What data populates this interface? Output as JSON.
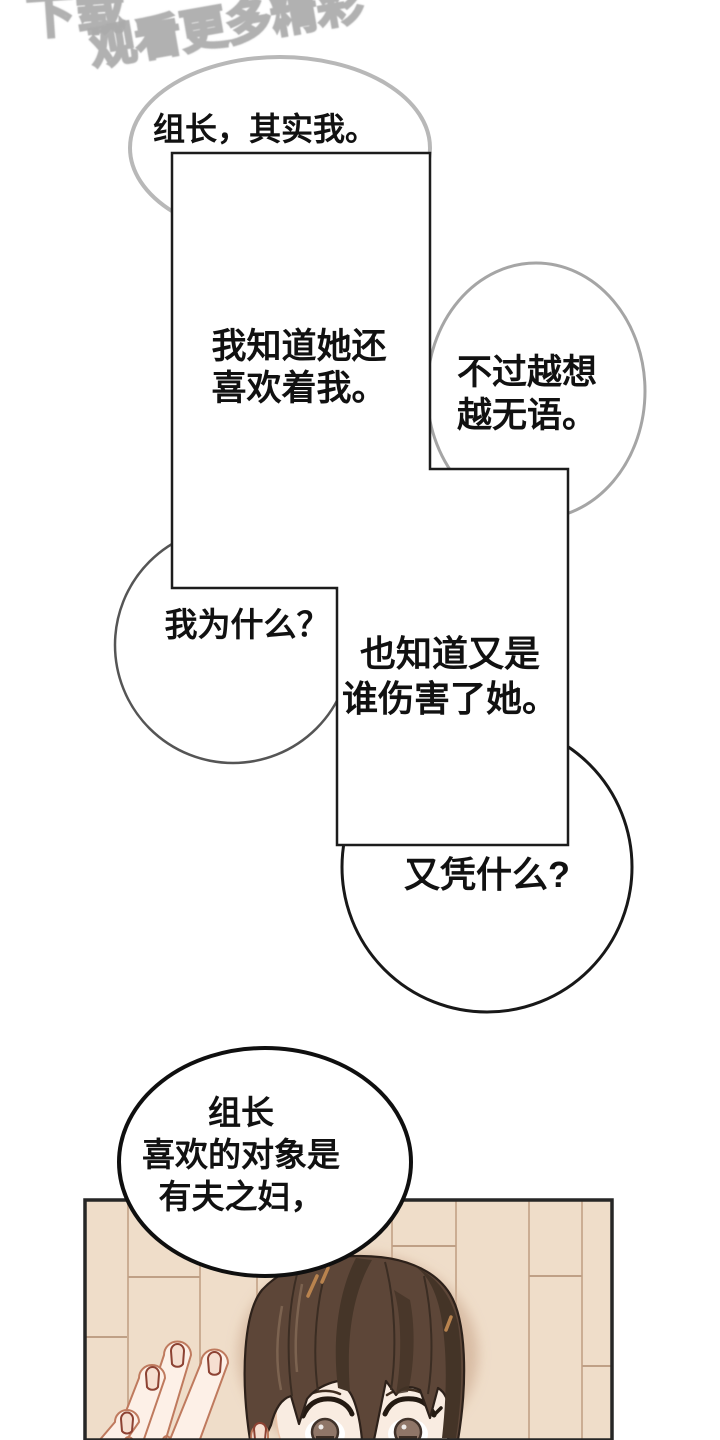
{
  "watermark": {
    "line1": "下载",
    "line2": "观看更多精彩"
  },
  "speech": {
    "top_circle": "组长，其实我。",
    "panel_a": {
      "line1": "我知道她还",
      "line2": "喜欢着我。"
    },
    "right_circle": {
      "line1": "不过越想",
      "line2": "越无语。"
    },
    "left_circle": "我为什么？",
    "panel_b": {
      "line1": "也知道又是",
      "line2": "谁伤害了她。"
    },
    "question_circle": "又凭什么?",
    "bottom_circle": {
      "line1": "组长",
      "line2": "喜欢的对象是",
      "line3": "有夫之妇，"
    }
  },
  "colors": {
    "background": "#ffffff",
    "text": "#111111",
    "watermark_stroke": "#ababab",
    "bubble_border_light": "#b8b8b8",
    "bubble_border_mid": "#a5a5a5",
    "bubble_border_dark": "#555555",
    "bubble_border_black": "#181818",
    "panel_border": "#1c1c1c",
    "photo_panel_border": "#262626",
    "wall": "#efddc9",
    "wall_plank_line": "#cbad93",
    "wall_seam_line": "#bfa086",
    "wall_shadow": "#d4b69d",
    "hair": "#5d4638",
    "hair_dark": "#453528",
    "hair_outline": "#2d211a",
    "hair_glint": "#b9834e",
    "skin": "#fdf0e7",
    "skin_face": "#f9ece1",
    "skin_line": "#bf7a5e",
    "nail_line": "#8d4233",
    "iris": "#8f7668"
  }
}
